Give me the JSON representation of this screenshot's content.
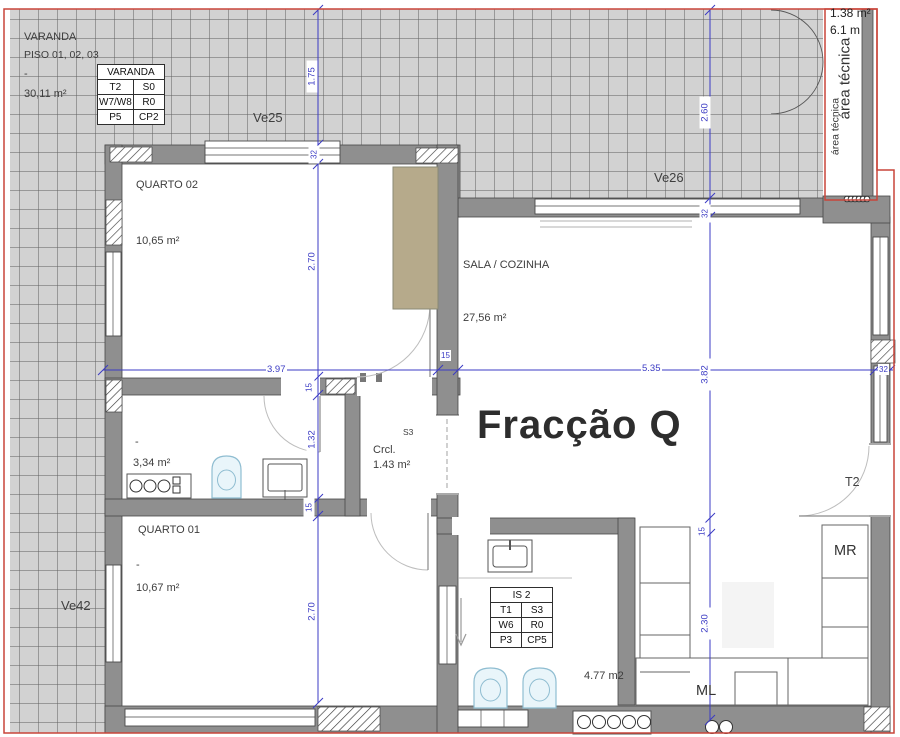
{
  "plan": {
    "title": "Fracção Q"
  },
  "terrace": {
    "name": "VARANDA",
    "floors": "PISO 01, 02, 03",
    "dash": "-",
    "area": "30,11 m²",
    "ve25": "Ve25",
    "ve26": "Ve26",
    "ve42": "Ve42"
  },
  "varanda_table": {
    "header": "VARANDA",
    "rows": [
      [
        "T2",
        "S0"
      ],
      [
        "W7/W8",
        "R0"
      ],
      [
        "P5",
        "CP2"
      ]
    ]
  },
  "area_tecnica": {
    "area": "1.38 m²",
    "length": "6.1 m",
    "label": "área técnica",
    "label2": "área técnica"
  },
  "rooms": {
    "quarto02": {
      "name": "QUARTO 02",
      "area": "10,65 m²"
    },
    "sala": {
      "name": "SALA / COZINHA",
      "area": "27,56 m²"
    },
    "wc": {
      "dash": "-",
      "area": "3,34 m²"
    },
    "quarto01": {
      "name": "QUARTO 01",
      "dash": "-",
      "area": "10,67 m²"
    },
    "crcl": {
      "name": "Crcl.",
      "area": "1.43 m²",
      "code": "S3"
    },
    "is2": {
      "area": "4.77 m2"
    }
  },
  "is2_table": {
    "header": "IS 2",
    "rows": [
      [
        "T1",
        "S3"
      ],
      [
        "W6",
        "R0"
      ],
      [
        "P3",
        "CP5"
      ]
    ]
  },
  "labels": {
    "mr": "MR",
    "ml": "ML",
    "t2": "T2"
  },
  "dims": {
    "left_line": [
      "1.75",
      "32",
      "2.70",
      "15",
      "1.32",
      "15",
      "2.70"
    ],
    "right_line": [
      "2.60",
      "32",
      "3.82",
      "15",
      "2.30"
    ],
    "horiz": [
      "3.97",
      "15",
      "5.35",
      "32"
    ]
  },
  "colors": {
    "dimension": "#3b3bc4",
    "boundary": "#c9453a",
    "wall": "#8f8f8f",
    "tile": "#d2d2d2",
    "wardrobe": "#b6aa8b",
    "fixture": "#e9f5fa"
  }
}
